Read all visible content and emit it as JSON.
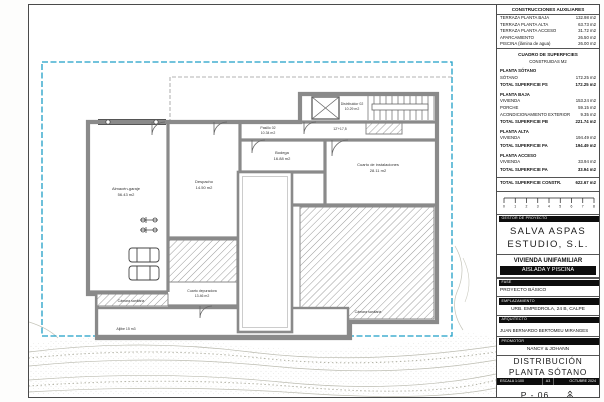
{
  "aux_table": {
    "title": "CONSTRUCCIONES AUXILIARES",
    "rows": [
      {
        "label": "TERRAZA PLANTA BAJA",
        "value": "132.98 m2"
      },
      {
        "label": "TERRAZA PLANTA ALTA",
        "value": "63.73 m2"
      },
      {
        "label": "TERRAZA PLANTA ACCESO",
        "value": "31.72 m2"
      },
      {
        "label": "APARCAMIENTO",
        "value": "26.50 m2"
      },
      {
        "label": "PISCINA (lámina de agua)",
        "value": "26.00 m2"
      }
    ]
  },
  "surface_table": {
    "title": "CUADRO DE SUPERFICIES",
    "subtitle": "CONSTRUIDAS M2",
    "rows": [
      {
        "label": "PLANTA SÓTANO",
        "value": ""
      },
      {
        "label": "SÓTANO",
        "value": "172.25 m2"
      },
      {
        "label": "TOTAL SUPERFICIE PS",
        "value": "172.25 m2"
      },
      {
        "label": "PLANTA BAJA",
        "value": ""
      },
      {
        "label": "VIVIENDA",
        "value": "153.24 m2"
      },
      {
        "label": "PORCHE",
        "value": "59.15 m2"
      },
      {
        "label": "ACONDICIONAMIENTO EXTERIOR",
        "value": "9.35 m2"
      },
      {
        "label": "TOTAL SUPERFICIE PB",
        "value": "221.74 m2"
      },
      {
        "label": "PLANTA ALTA",
        "value": ""
      },
      {
        "label": "VIVIENDA",
        "value": "194.49 m2"
      },
      {
        "label": "TOTAL SUPERFICIE PA",
        "value": "194.49 m2"
      },
      {
        "label": "PLANTA ACCESO",
        "value": ""
      },
      {
        "label": "VIVIENDA",
        "value": "33.94 m2"
      },
      {
        "label": "TOTAL SUPERFICIE PA",
        "value": "33.94 m2"
      },
      {
        "label": "TOTAL SUPERFICIE CONSTR.",
        "value": "622.67 m2"
      }
    ]
  },
  "scale_bar": {
    "ticks": [
      "0",
      "1",
      "2",
      "3",
      "4",
      "5",
      "6",
      "7",
      "8"
    ]
  },
  "title_block": {
    "gestor_label": "GESTOR DE PROYECTO",
    "studio_line1": "SALVA ASPAS",
    "studio_line2": "ESTUDIO, S.L.",
    "project_line1": "VIVIENDA UNIFAMILIAR",
    "project_line2": "AISLADA Y PISCINA",
    "fase_label": "FASE",
    "fase_value": "PROYECTO BÁSICO",
    "emplazamiento_label": "EMPLAZAMIENTO",
    "emplazamiento_value": "URB. EMPEDROLA, 24 B, CALPE",
    "arquitecto_label": "ARQUITECTO",
    "arquitecto_value": "JUAN BERNARDO BERTOMEU MIRANGES",
    "promotor_label": "PROMOTOR",
    "promotor_value": "NANCY & JOHANN",
    "drawing_title_line1": "DISTRIBUCIÓN",
    "drawing_title_line2": "PLANTA SÓTANO",
    "escala": "ESCALA 1:100",
    "formato": "A3",
    "fecha": "OCTUBRE 2024",
    "sheet_number": "P - 06"
  },
  "plan": {
    "rooms": [
      {
        "name": "Almacén-garaje",
        "area": "56.43 m2"
      },
      {
        "name": "Despacho",
        "area": "14.50 m2"
      },
      {
        "name": "Pasillo 02",
        "area": "10.34 m2"
      },
      {
        "name": "Distribuidor 02",
        "area": "10.29 m2"
      },
      {
        "name": "Bodega",
        "area": "16.88 m2"
      },
      {
        "name": "Cuarto de instalaciones",
        "area": "28.11 m2"
      },
      {
        "name": "Cuarto depuradora",
        "area": "13.46 m2"
      },
      {
        "name": "Cámara sanitaria",
        "area": ""
      },
      {
        "name": "Cámara sanitaria",
        "area": ""
      },
      {
        "name": "Aljibe 15 m3",
        "area": ""
      }
    ],
    "annotations": {
      "stair_note": "12'+17,5"
    },
    "colors": {
      "boundary": "#1f9fc6",
      "wall": "#8a8a8a",
      "hatch": "#9a9a9a",
      "terrain": "#bdbdb2"
    }
  }
}
